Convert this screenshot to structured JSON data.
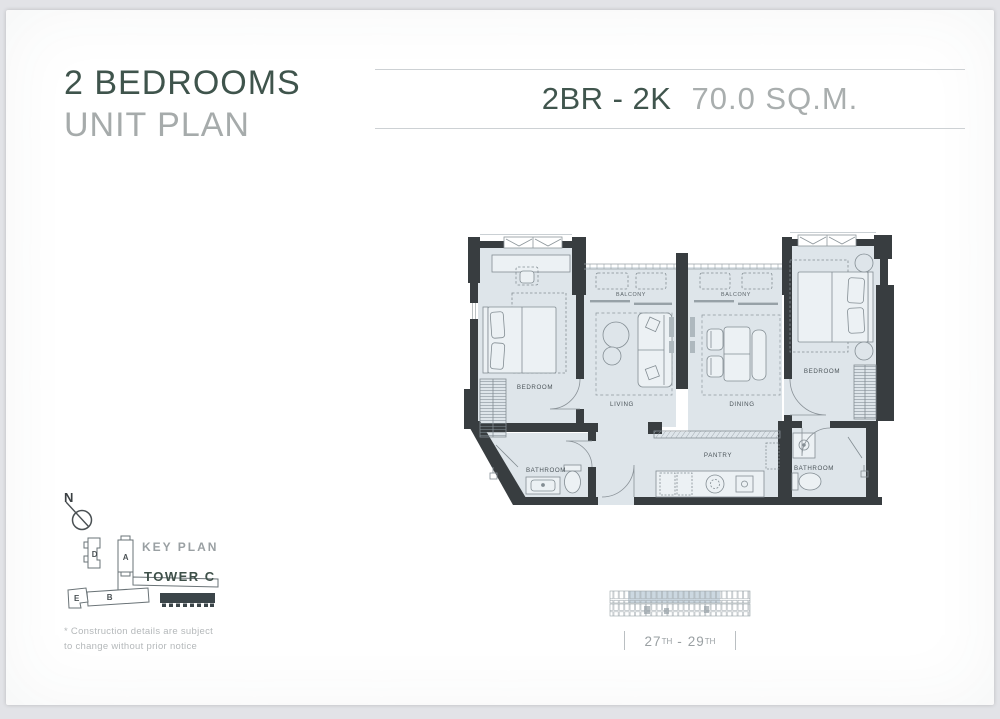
{
  "header": {
    "title_line1": "2 BEDROOMS",
    "title_line2": "UNIT PLAN",
    "unit_code": "2BR - 2K",
    "unit_area": "70.0 SQ.M."
  },
  "floor_plan": {
    "rooms": {
      "bedroom_left": "BEDROOM",
      "balcony_left": "BALCONY",
      "balcony_right": "BALCONY",
      "bedroom_right": "BEDROOM",
      "living": "LIVING",
      "dining": "DINING",
      "bathroom_left": "BATHROOM",
      "pantry": "PANTRY",
      "bathroom_right": "BATHROOM"
    }
  },
  "key_plan": {
    "compass_label": "N",
    "title": "KEY PLAN",
    "tower_label": "TOWER C",
    "building_a": "A",
    "building_b": "B",
    "building_d": "D",
    "building_e": "E"
  },
  "floor_range": {
    "from": "27",
    "from_ordinal": "TH",
    "separator": "-",
    "to": "29",
    "to_ordinal": "TH"
  },
  "disclaimer": {
    "line1": "* Construction details are subject",
    "line2": "to change without prior notice"
  },
  "colors": {
    "accent": "#3f544c",
    "muted": "#a9aeae",
    "wall": "#383d40",
    "floor": "#dee5ea",
    "tower_highlight": "#3b4549"
  }
}
